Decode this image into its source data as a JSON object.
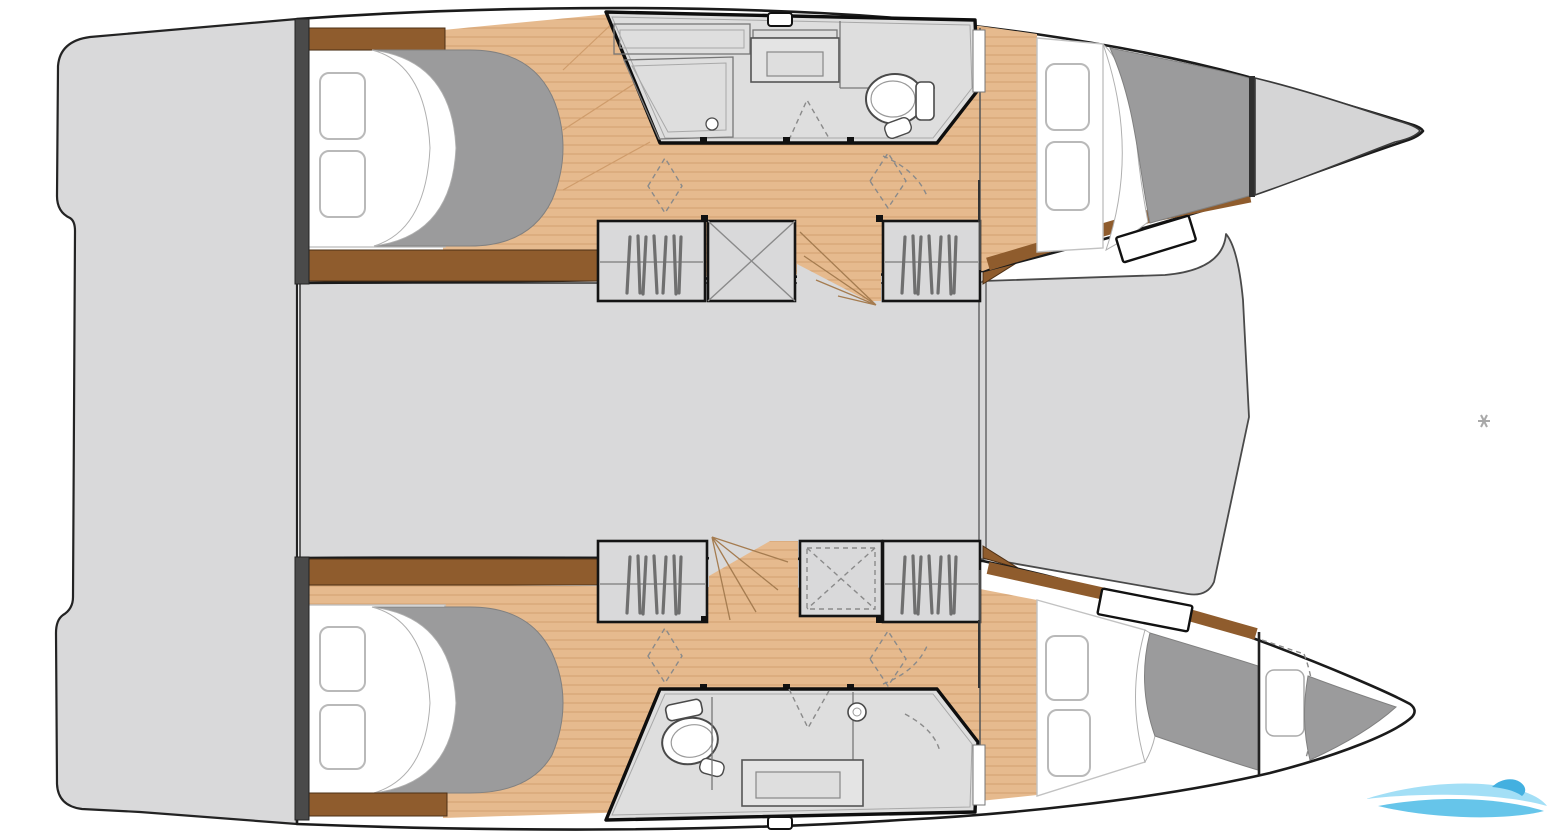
{
  "document": {
    "type": "catamaran-yacht-layout-floor-plan",
    "orientation": "bow-right",
    "visible_text": ""
  },
  "palette": {
    "background": "#ffffff",
    "hull_fill": "#ffffff",
    "outline": "#1b1b1b",
    "deck": "#d9d9da",
    "deck_light": "#dedede",
    "bow_locker": "#d5d5d6",
    "wall": "#4a4a4a",
    "wood": "#e6ba8e",
    "wood_line": "#cf9c6b",
    "trim_brown": "#8f5c2d",
    "duvet": "#9b9b9c",
    "pillow_border": "#b9b9b9",
    "fixture_line": "#4a4a4a",
    "dash_gray": "#8a8a8a",
    "marker_gray": "#a9a9a9",
    "watermark_blue_light": "#9adcf6",
    "watermark_blue": "#56bfe8",
    "watermark_blue_dark": "#2fa8dd"
  },
  "rooms": {
    "aft_platform": "stern-platform-with-steps",
    "saloon": "central-saloon-bridgedeck",
    "foredeck": "forward-bridgedeck",
    "port_hull": [
      "aft-double-cabin",
      "shower-room-with-toilet",
      "wardrobes-and-companionway",
      "forward-double-cabin",
      "bow-locker"
    ],
    "starboard_hull": [
      "aft-double-cabin",
      "shower-room-with-toilet",
      "wardrobes-and-companionway",
      "forward-double-cabin",
      "forepeak-berth"
    ]
  },
  "fixtures": {
    "beds": 5,
    "pillows_per_bed": 2,
    "toilets": 2,
    "sinks": 2,
    "wardrobes": 4,
    "stair_flights": 2
  },
  "watermark": {
    "style": "wave-swoosh-logo",
    "position": "bottom-right"
  },
  "marker": {
    "glyph": "small-cross-artifact",
    "position": "right-middle"
  }
}
